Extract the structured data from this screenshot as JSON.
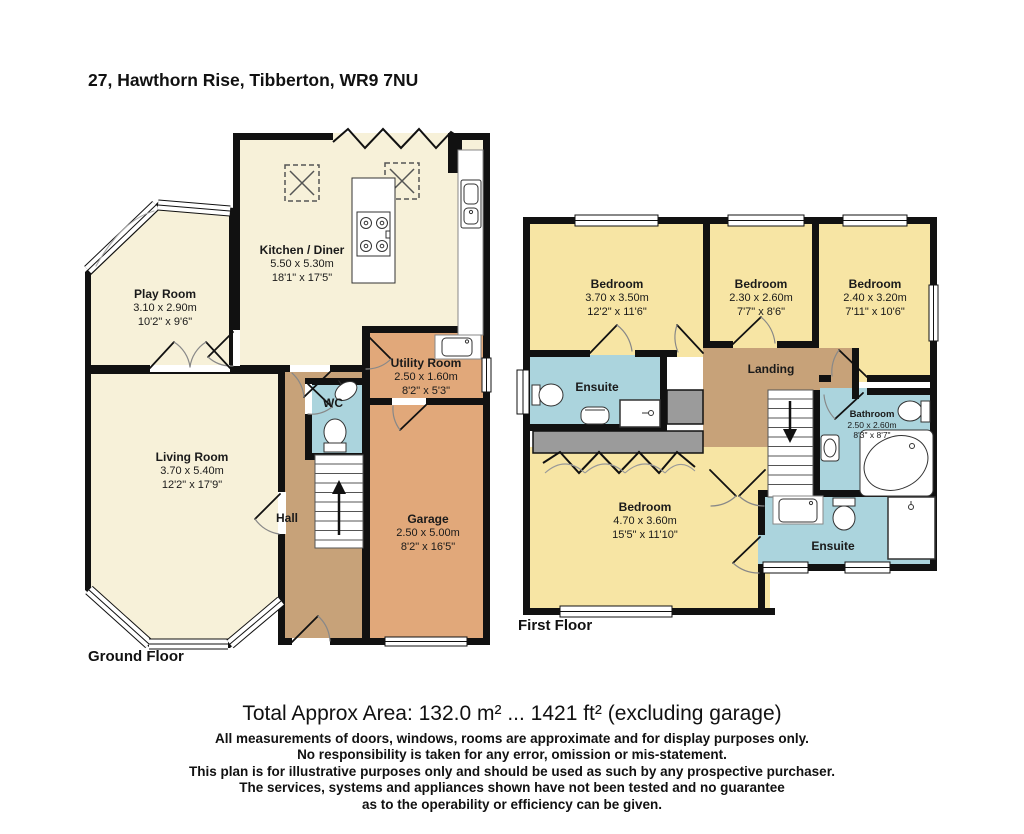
{
  "title": "27, Hawthorn Rise, Tibberton, WR9 7NU",
  "colors": {
    "wall": "#111111",
    "cream": "#f7f1d9",
    "yellow": "#f7e5a4",
    "blue": "#abd4dd",
    "tan": "#c7a279",
    "salmon": "#e1a87a",
    "gray": "#9b9b9b"
  },
  "ground_floor": {
    "label": "Ground Floor",
    "rooms": {
      "play_room": {
        "name": "Play Room",
        "metric": "3.10 x 2.90m",
        "imperial": "10'2\" x 9'6\""
      },
      "kitchen": {
        "name": "Kitchen / Diner",
        "metric": "5.50 x 5.30m",
        "imperial": "18'1\" x 17'5\""
      },
      "utility": {
        "name": "Utility Room",
        "metric": "2.50 x 1.60m",
        "imperial": "8'2\" x 5'3\""
      },
      "wc": {
        "name": "WC"
      },
      "living_room": {
        "name": "Living Room",
        "metric": "3.70 x 5.40m",
        "imperial": "12'2\" x 17'9\""
      },
      "hall": {
        "name": "Hall"
      },
      "garage": {
        "name": "Garage",
        "metric": "2.50 x 5.00m",
        "imperial": "8'2\" x 16'5\""
      }
    }
  },
  "first_floor": {
    "label": "First Floor",
    "rooms": {
      "bedroom1": {
        "name": "Bedroom",
        "metric": "3.70 x 3.50m",
        "imperial": "12'2\" x 11'6\""
      },
      "bedroom2": {
        "name": "Bedroom",
        "metric": "2.30 x 2.60m",
        "imperial": "7'7\" x 8'6\""
      },
      "bedroom3": {
        "name": "Bedroom",
        "metric": "2.40 x 3.20m",
        "imperial": "7'11\" x 10'6\""
      },
      "bedroom4": {
        "name": "Bedroom",
        "metric": "4.70 x 3.60m",
        "imperial": "15'5\" x 11'10\""
      },
      "ensuite1": {
        "name": "Ensuite"
      },
      "ensuite2": {
        "name": "Ensuite"
      },
      "bathroom": {
        "name": "Bathroom",
        "metric": "2.50 x 2.60m",
        "imperial": "8'3\" x 8'7\""
      },
      "landing": {
        "name": "Landing"
      }
    }
  },
  "footer": {
    "area_line": "Total Approx Area: 132.0 m² ... 1421 ft² (excluding garage)",
    "disclaimer_lines": [
      "All measurements of doors, windows, rooms are approximate and for display purposes only.",
      "No responsibility is taken for any error, omission or mis-statement.",
      "This plan is for illustrative purposes only and should be used as such by any prospective purchaser.",
      "The services, systems and appliances shown have not been tested and no guarantee",
      "as to the operability or efficiency can be given."
    ]
  }
}
